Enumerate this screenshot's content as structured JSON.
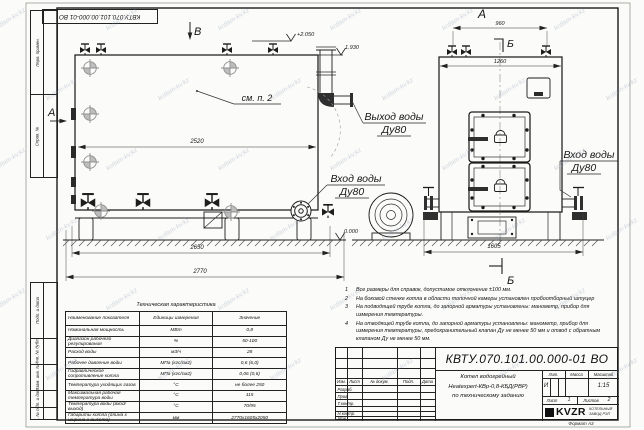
{
  "sheet": {
    "watermark": "kotlam-kv.kz",
    "format_label": "Формат А3"
  },
  "margin_labels": {
    "perv_primen": "Перв. примен.",
    "sprav_no": "Справ. №",
    "podp_data1": "Подп. и дата",
    "inv_dubl": "Инв. № дубл.",
    "vzam_inv": "Взам. инв. №",
    "podp_data2": "Подп. и дата",
    "inv_podl": "Инв. № подл."
  },
  "side_view": {
    "view_letter_top": "В",
    "view_letter_left": "А",
    "note_ref": "см. п. 2",
    "level_top": "+2.050",
    "level_pipe": "1.930",
    "level_ground": "0.000",
    "dim_width_inner": "2520",
    "dim_base": "2650",
    "dim_overall": "2770",
    "outlet_line1": "Выход воды",
    "outlet_line2": "Ду80",
    "inlet_line1": "Вход воды",
    "inlet_line2": "Ду80"
  },
  "front_view": {
    "view_letter": "А",
    "section_letter": "Б",
    "dim_valves": "960",
    "dim_width": "1260",
    "dim_base": "1605",
    "inlet_line1": "Вход воды",
    "inlet_line2": "Ду80"
  },
  "tech_table": {
    "title": "Техническая характеристика",
    "headers": [
      "Наименование показателя",
      "Единицы измерения",
      "Значение"
    ],
    "rows": [
      [
        "Номинальная мощность",
        "МВт",
        "0,8"
      ],
      [
        "Диапазон рабочего регулирования",
        "%",
        "50-100"
      ],
      [
        "Расход воды",
        "м3/ч",
        "28"
      ],
      [
        "Рабочее давление воды",
        "МПа (кгс/см2)",
        "0,6 (6,0)"
      ],
      [
        "Гидравлическое сопротивление котла",
        "МПа (кгс/см2)",
        "0,06 (0,6)"
      ],
      [
        "Температура уходящих газов",
        "°С",
        "не более 250"
      ],
      [
        "Максимальная рабочая температура воды",
        "°С",
        "115"
      ],
      [
        "Температура воды (вход/выход)",
        "°С",
        "70/95"
      ],
      [
        "Габариты котла (длина х ширина х высота)",
        "мм",
        "2770х1605х2050"
      ]
    ]
  },
  "notes": [
    {
      "num": "1",
      "text": "Все размеры для справок, допустимое отклонение ±100 мм."
    },
    {
      "num": "2",
      "text": "На боковой стенке котла в области топочной камеры установлен пробоотборный штуцер"
    },
    {
      "num": "3",
      "text": "На подводящей трубе котла, до запорной арматуры установлены: манометр, прибор для измерения температуры."
    },
    {
      "num": "4",
      "text": "На отводящей трубе котла, до запорной арматуры установлены: манометр, прибор для измерения температуры, предохранительный клапан Ду не менее 50 мм и отвод с обратным клапаном Ду не менее 50 мм."
    }
  ],
  "title_block": {
    "doc_number": "КВТУ.070.101.00.000-01 ВО",
    "header_cols": {
      "izm": "Изм.",
      "list": "Лист",
      "docum": "№ докум.",
      "podp": "Подп.",
      "data": "Дата"
    },
    "rows": {
      "razrab": "Разраб.",
      "prov": "Пров.",
      "tkontr": "Т.контр.",
      "nkontr": "Н.контр.",
      "utv": "Утв."
    },
    "description": {
      "line1": "Котел водогрейный",
      "line2": "Heatexpert-КВр-0,8-КБД(РВР)",
      "line3": "по техническому заданию"
    },
    "lit_header": "Лит.",
    "lit_value": "И",
    "massa_header": "Масса",
    "masshtab_header": "Масштаб",
    "masshtab_value": "1:15",
    "list_label": "Лист",
    "list_value": "1",
    "listov_label": "Листов",
    "listov_value": "2",
    "company": {
      "logo": "KVZR",
      "line1": "КОТЕЛЬНЫЙ",
      "line2": "ЗАВОД РЭП"
    }
  }
}
